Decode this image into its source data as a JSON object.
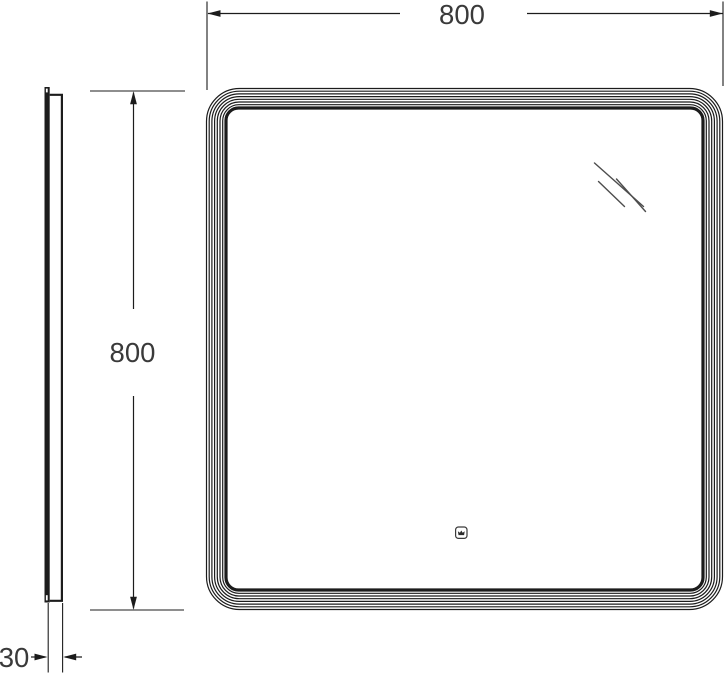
{
  "dimensions": {
    "width": {
      "label": "800"
    },
    "height": {
      "label": "800"
    },
    "depth": {
      "label": "30"
    }
  },
  "icons": {
    "shine": "glass-shine-icon",
    "sensor": "touch-sensor-crown-icon"
  },
  "colors": {
    "line": "#1c1c1c",
    "dim_text": "#3a3a3a",
    "background": "#ffffff"
  }
}
